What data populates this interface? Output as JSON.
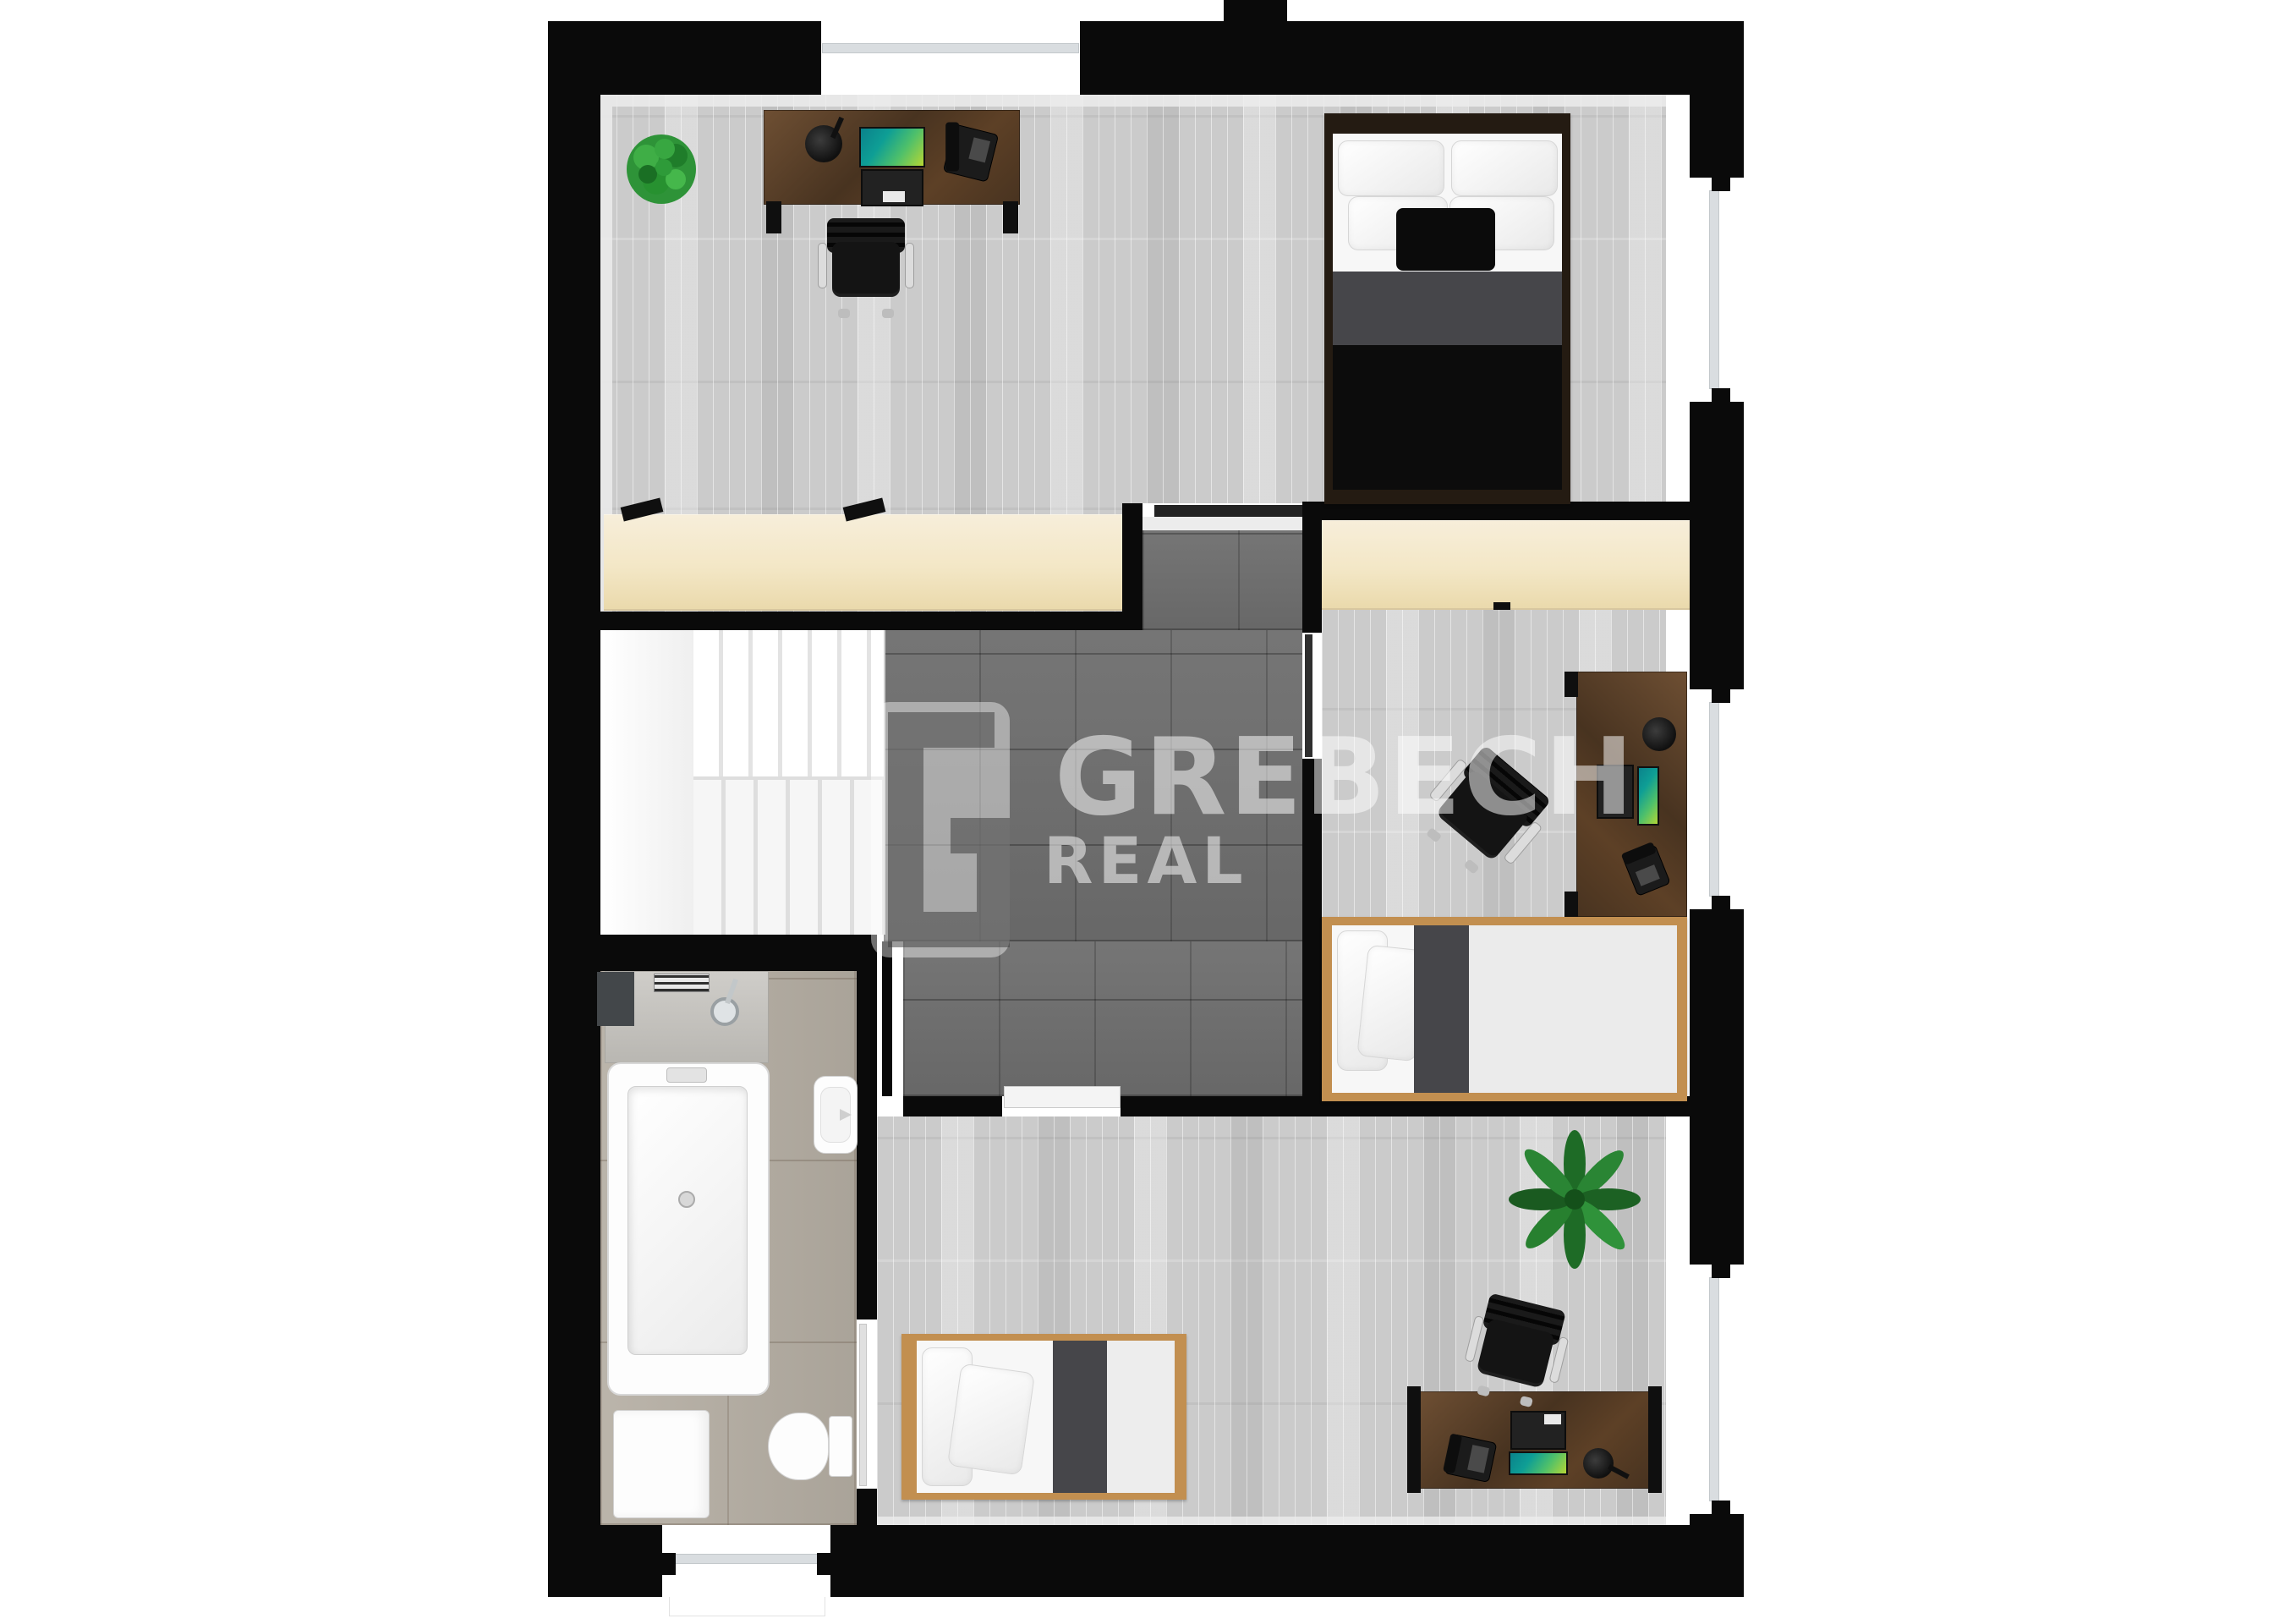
{
  "watermark": {
    "logo_letter": "G",
    "brand": "GREBECH",
    "brand_sub": "REAL"
  },
  "colors": {
    "wall": "#0a0a0a",
    "face": "#ececec",
    "wood": "#cbcbcb",
    "tile": "#6e6e6e",
    "bath": "#b3aca1",
    "ward": "#f3e7c6",
    "walnut1": "#6e4f33",
    "walnut2": "#483320",
    "oak": "#c28f50",
    "mattress": "#f7f7f7",
    "blanket": "#46464a",
    "duvet": "#0c0c0c",
    "bedframe": "#241b12",
    "screena": "#0e9e95",
    "screenb": "#c0d82f",
    "chair": "#141414",
    "stair": "#f6f6f6",
    "stairedge": "#dedede",
    "wm": "rgba(255,255,255,0.52)",
    "wmdark": "rgba(55,55,55,0.5)",
    "door": "#232323"
  },
  "scene": {
    "type": "floor-plan-3d-top-view",
    "floor": "upper",
    "rooms": [
      {
        "name": "bedroom-office",
        "floor_finish": "light-gray-parquet",
        "furniture": [
          "desk",
          "desk-lamp",
          "laptop",
          "telephone",
          "office-chair",
          "potted-plant",
          "wardrobe",
          "double-bed"
        ]
      },
      {
        "name": "kids-room-east",
        "floor_finish": "light-gray-parquet",
        "furniture": [
          "wardrobe",
          "desk",
          "desk-lamp",
          "laptop",
          "telephone",
          "office-chair",
          "single-bed"
        ]
      },
      {
        "name": "kids-room-south",
        "floor_finish": "light-gray-parquet",
        "furniture": [
          "single-bed",
          "desk",
          "desk-lamp",
          "laptop",
          "telephone",
          "office-chair",
          "potted-plant"
        ]
      },
      {
        "name": "bathroom",
        "floor_finish": "beige-stone-tile",
        "furniture": [
          "shower",
          "bathtub",
          "washing-machine",
          "toilet",
          "washbasin"
        ]
      },
      {
        "name": "hallway-landing",
        "floor_finish": "dark-gray-tile",
        "furniture": [
          "staircase"
        ]
      }
    ],
    "windows": [
      "top-wall-window",
      "east-wall-window-1",
      "east-wall-window-2",
      "east-wall-window-3",
      "south-wall-window"
    ]
  }
}
